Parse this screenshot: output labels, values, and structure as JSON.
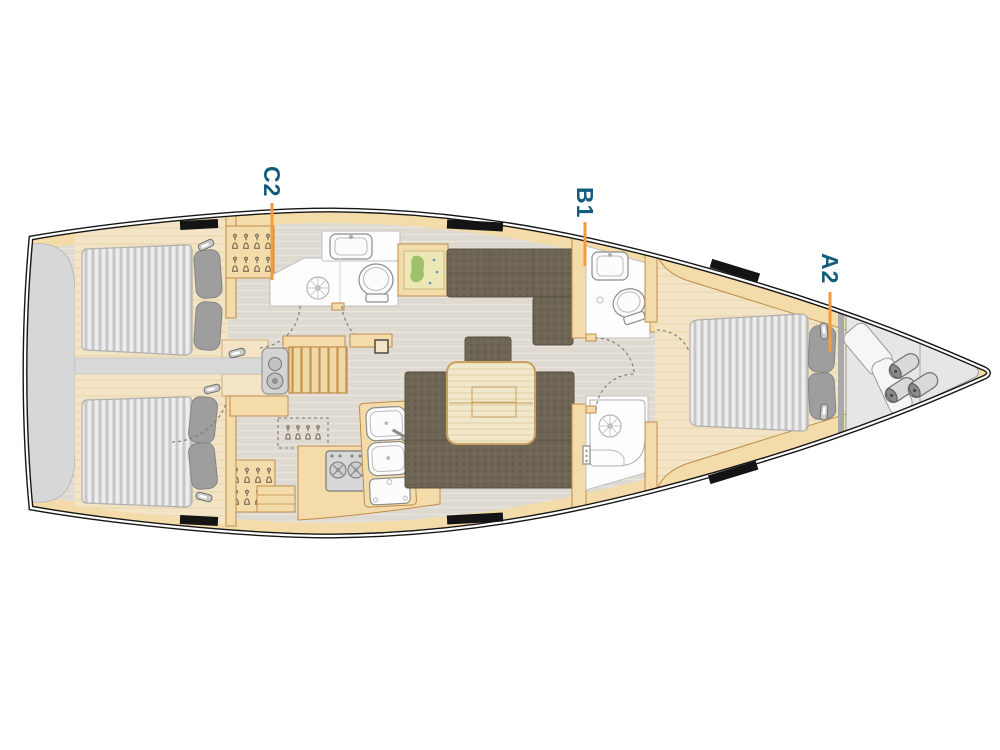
{
  "diagram": {
    "type": "sailboat-interior-floor-plan",
    "orientation": {
      "bow": "right",
      "stern": "left"
    },
    "cabin_labels": {
      "c2": "C2",
      "b1": "B1",
      "a2": "A2"
    },
    "features": [
      "swim-platform",
      "aft-double-berth-port",
      "aft-double-berth-starboard",
      "aft-head-with-shower",
      "wardrobe-hanger-icons",
      "companionway-steps",
      "engine-unit",
      "galley-stove",
      "galley-double-sink",
      "galley-fridge",
      "chart-table-with-map",
      "salon-settee",
      "salon-u-settee",
      "salon-table",
      "mast-post",
      "forward-head-toilet-sink",
      "forward-shower",
      "forward-double-berth",
      "bow-locker-fenders",
      "deck-hatches"
    ]
  },
  "colors": {
    "label_text": "#135C7D",
    "leader_line": "#F59B3B",
    "hull_outline": "#161616",
    "floor": "#DEDAD2",
    "floor_grain": "#E9E5DD",
    "wood_cabinet": "#F3DCA9",
    "wood_cabinet_border": "#C08C4A",
    "wood_light": "#F2E4C4",
    "wood_light_grain": "#E7D6AC",
    "table_wood": "#F1E7CB",
    "table_grain": "#E3D4AE",
    "settee": "#6E6554",
    "settee_border": "#57503F",
    "mattress": "#EDEDED",
    "mattress_stripe": "#C7C7C7",
    "pillow": "#9E9E9E",
    "platform_gray": "#D7D7D7",
    "locker_gray": "#E6E6E9",
    "fixture_white": "#FCFCFC",
    "fixture_stroke": "#8C8C8C",
    "map_paper": "#EDE7B8",
    "map_land": "#9CC168",
    "map_water": "#5F93C3"
  }
}
